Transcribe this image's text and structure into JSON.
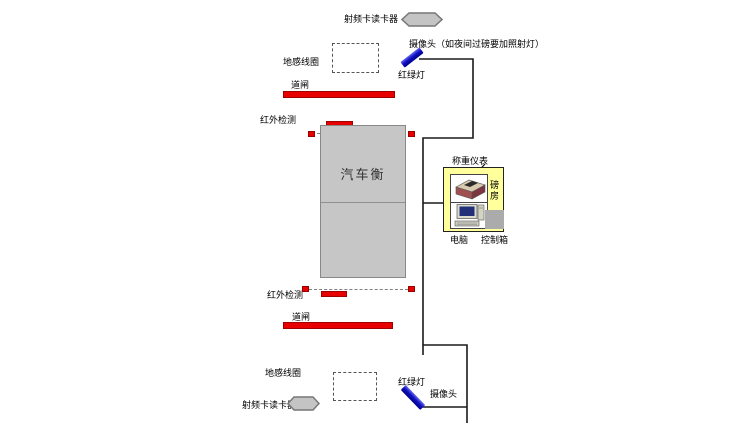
{
  "colors": {
    "device_red": "#e60000",
    "light_blue": "#0000c0",
    "scale_gray": "#c6c6c6",
    "house_yellow": "#ffff9c",
    "reader_gray": "#c4c4c4",
    "wire_black": "#1a1a1a"
  },
  "top_lane": {
    "rfid_reader_label": "射频卡读卡器",
    "camera_label": "摄像头（如夜间过磅要加照射灯）",
    "ground_loop_label": "地感线圈",
    "traffic_light_label": "红绿灯",
    "barrier_label": "道闸",
    "infrared_label": "红外检测"
  },
  "scale": {
    "label": "汽车衡"
  },
  "weigh_house": {
    "meter_label": "称重仪表",
    "room_label": "磅房",
    "computer_label": "电脑",
    "control_box_label": "控制箱"
  },
  "bottom_lane": {
    "infrared_label": "红外检测",
    "barrier_label": "道闸",
    "ground_loop_label": "地感线圈",
    "rfid_reader_label": "射频卡读卡器",
    "traffic_light_label": "红绿灯",
    "camera_label": "摄像头"
  }
}
